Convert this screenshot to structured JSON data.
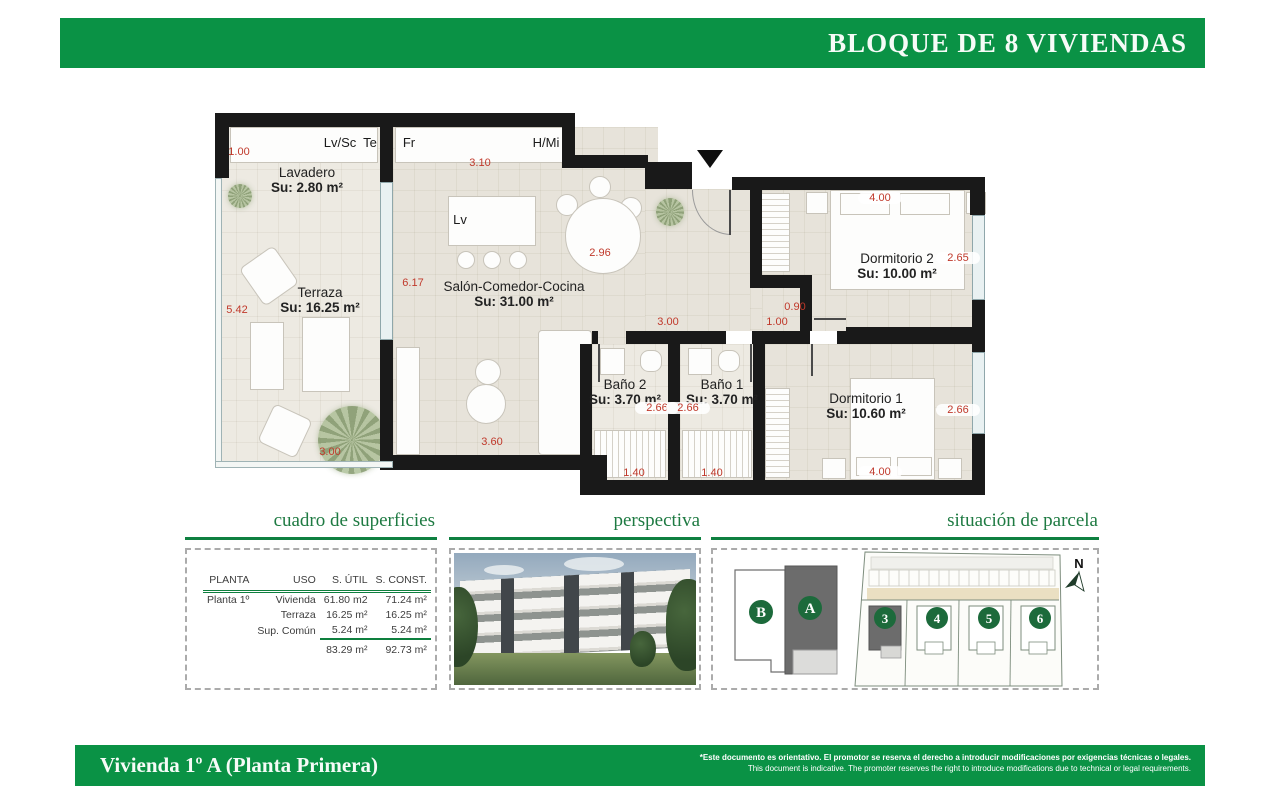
{
  "header": {
    "block_title": "BLOQUE DE 8 VIVIENDAS"
  },
  "plan": {
    "rooms": [
      {
        "name": "Lavadero",
        "area": "Su: 2.80 m²"
      },
      {
        "name": "Terraza",
        "area": "Su: 16.25 m²"
      },
      {
        "name": "Salón-Comedor-Cocina",
        "area": "Su: 31.00 m²"
      },
      {
        "name": "Baño 2",
        "area": "Su: 3.70 m²"
      },
      {
        "name": "Baño 1",
        "area": "Su: 3.70 m²"
      },
      {
        "name": "Dormitorio 2",
        "area": "Su: 10.00 m²"
      },
      {
        "name": "Dormitorio 1",
        "area": "Su: 10.60 m²"
      }
    ],
    "appliance_labels": [
      "Lv/Sc",
      "Te",
      "Fr",
      "H/Mi",
      "Lv"
    ],
    "dimensions": [
      "1.00",
      "3.10",
      "2.96",
      "6.17",
      "5.42",
      "3.00",
      "0.90",
      "1.00",
      "4.00",
      "2.65",
      "2.66",
      "2.66",
      "1.40",
      "1.40",
      "2.66",
      "4.00",
      "3.60",
      "3.00"
    ]
  },
  "sections": {
    "surfaces": {
      "title": "cuadro de superficies",
      "columns": [
        "PLANTA",
        "USO",
        "S. ÚTIL",
        "S. CONST."
      ],
      "rows": [
        {
          "planta": "Planta 1º",
          "uso": "Vivienda",
          "util": "61.80 m2",
          "construida": "71.24 m²"
        },
        {
          "planta": "",
          "uso": "Terraza",
          "util": "16.25 m²",
          "construida": "16.25 m²"
        },
        {
          "planta": "",
          "uso": "Sup. Común",
          "util": "5.24 m²",
          "construida": "5.24 m²"
        }
      ],
      "total": {
        "util": "83.29 m²",
        "construida": "92.73 m²"
      }
    },
    "perspective": {
      "title": "perspectiva"
    },
    "site": {
      "title": "situación de parcela",
      "north_label": "N",
      "blocks": [
        {
          "label": "B"
        },
        {
          "label": "A"
        }
      ],
      "plots": [
        {
          "label": "3"
        },
        {
          "label": "4"
        },
        {
          "label": "5"
        },
        {
          "label": "6"
        }
      ]
    }
  },
  "footer": {
    "title": "Vivienda 1º A (Planta Primera)",
    "disclaimer_es": "*Este documento es orientativo. El promotor se reserva el derecho a introducir modificaciones por exigencias técnicas o legales.",
    "disclaimer_en": "This document is indicative. The promoter reserves the right to introduce modifications due to technical or legal requirements."
  },
  "colors": {
    "brand_green": "#0a9245",
    "title_green": "#1e7a42",
    "dim_red": "#c0392b",
    "wall_black": "#191919",
    "circle_green": "#1c6a3b"
  }
}
